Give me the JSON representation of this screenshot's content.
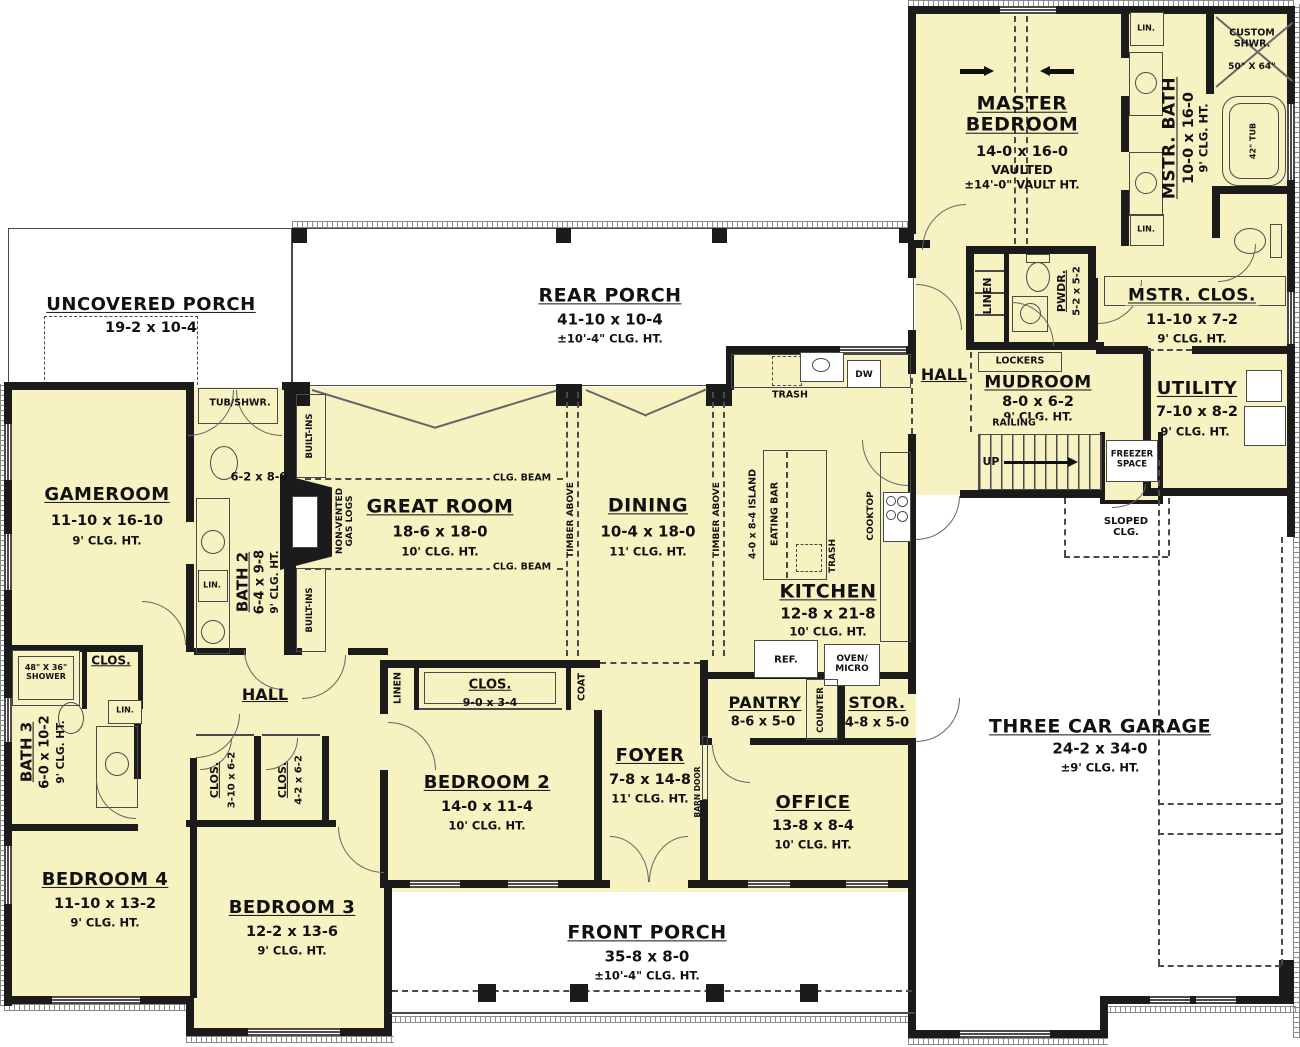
{
  "plan": {
    "colors": {
      "floor": "#f6f2c2",
      "wall": "#1b1b1b"
    },
    "rooms": {
      "master_bedroom": {
        "name": "MASTER BEDROOM",
        "dims": "14-0 x 16-0",
        "note": "VAULTED",
        "note2": "±14'-0\" VAULT HT."
      },
      "mstr_bath": {
        "name": "MSTR. BATH",
        "dims": "10-0 x 16-0",
        "clg": "9' CLG. HT."
      },
      "custom_shwr": {
        "name": "CUSTOM SHWR.",
        "dims": "50\" X 64\""
      },
      "tub42": {
        "name": "42\" TUB"
      },
      "mstr_clos": {
        "name": "MSTR. CLOS.",
        "dims": "11-10 x 7-2",
        "clg": "9' CLG. HT."
      },
      "pwdr": {
        "name": "PWDR.",
        "dims": "5-2 x 5-2"
      },
      "utility": {
        "name": "UTILITY",
        "dims": "7-10 x 8-2",
        "clg": "9' CLG. HT."
      },
      "mudroom": {
        "name": "MUDROOM",
        "dims": "8-0 x 6-2",
        "clg": "9' CLG. HT."
      },
      "hall_right": {
        "name": "HALL"
      },
      "hall_left": {
        "name": "HALL"
      },
      "garage": {
        "name": "THREE CAR GARAGE",
        "dims": "24-2 x 34-0",
        "clg": "±9' CLG. HT."
      },
      "rear_porch": {
        "name": "REAR PORCH",
        "dims": "41-10 x 10-4",
        "clg": "±10'-4\" CLG. HT."
      },
      "front_porch": {
        "name": "FRONT PORCH",
        "dims": "35-8 x 8-0",
        "clg": "±10'-4\" CLG. HT."
      },
      "uncovered_porch": {
        "name": "UNCOVERED PORCH",
        "dims": "19-2 x 10-4"
      },
      "gameroom": {
        "name": "GAMEROOM",
        "dims": "11-10 x 16-10",
        "clg": "9' CLG. HT."
      },
      "bath2": {
        "name": "BATH 2",
        "dims": "6-4 x 9-8",
        "clg": "9' CLG. HT.",
        "vanity": "6-2 x 8-0"
      },
      "bath3": {
        "name": "BATH 3",
        "dims": "6-0 x 10-2",
        "clg": "9' CLG. HT."
      },
      "great_room": {
        "name": "GREAT ROOM",
        "dims": "18-6 x 18-0",
        "clg": "10' CLG. HT."
      },
      "dining": {
        "name": "DINING",
        "dims": "10-4 x 18-0",
        "clg": "11' CLG. HT."
      },
      "kitchen": {
        "name": "KITCHEN",
        "dims": "12-8 x 21-8",
        "clg": "10' CLG. HT."
      },
      "pantry": {
        "name": "PANTRY",
        "dims": "8-6 x 5-0"
      },
      "stor": {
        "name": "STOR.",
        "dims": "4-8 x 5-0"
      },
      "office": {
        "name": "OFFICE",
        "dims": "13-8 x 8-4",
        "clg": "10' CLG. HT."
      },
      "foyer": {
        "name": "FOYER",
        "dims": "7-8 x 14-8",
        "clg": "11' CLG. HT."
      },
      "bedroom2": {
        "name": "BEDROOM 2",
        "dims": "14-0 x 11-4",
        "clg": "10' CLG. HT."
      },
      "bedroom3": {
        "name": "BEDROOM 3",
        "dims": "12-2 x 13-6",
        "clg": "9' CLG. HT."
      },
      "bedroom4": {
        "name": "BEDROOM 4",
        "dims": "11-10 x 13-2",
        "clg": "9' CLG. HT."
      },
      "clos_hall": {
        "name": "CLOS."
      },
      "clos_b2": {
        "name": "CLOS.",
        "dims": "9-0 x 3-4"
      },
      "clos3": {
        "name": "CLOS.",
        "dims": "3-10 x 6-2"
      },
      "clos4": {
        "name": "CLOS.",
        "dims": "4-2 x 6-2"
      },
      "shower48": {
        "name": "48\" X 36\" SHOWER"
      }
    },
    "fixtures": {
      "lin": "LIN.",
      "linen": "LINEN",
      "lockers": "LOCKERS",
      "railing": "RAILING",
      "up": "UP",
      "freezer": "FREEZER SPACE",
      "sloped": "SLOPED CLG.",
      "tub_shwr": "TUB/SHWR.",
      "built_ins": "BUILT-INS",
      "gas_logs": "NON-VENTED GAS LOGS",
      "clg_beam": "CLG. BEAM",
      "timber": "TIMBER ABOVE",
      "trash": "TRASH",
      "dw": "DW",
      "island": "4-0 x 8-4 ISLAND",
      "eating_bar": "EATING BAR",
      "cooktop": "COOKTOP",
      "ref": "REF.",
      "oven": "OVEN/ MICRO",
      "counter": "COUNTER",
      "coat": "COAT",
      "barn_door": "BARN DOOR"
    }
  }
}
